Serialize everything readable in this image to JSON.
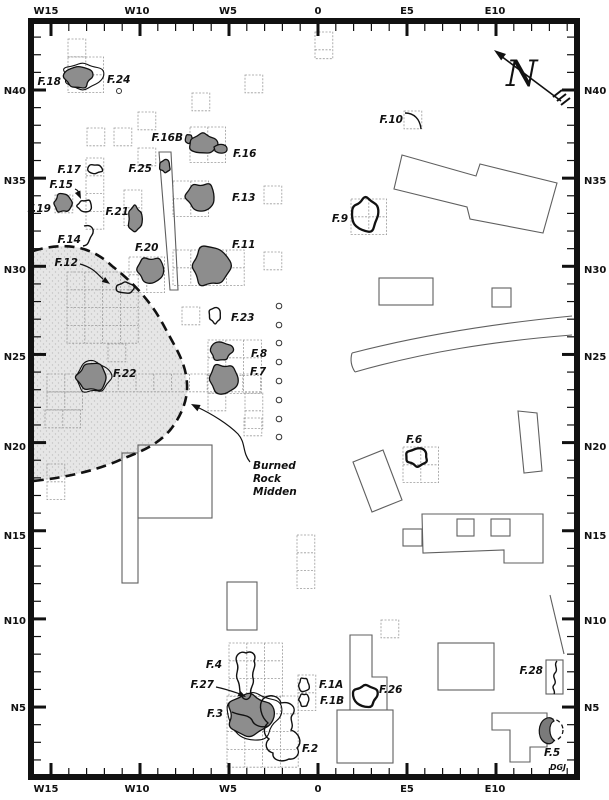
{
  "credit": "DGJ",
  "north": {
    "letter": "N",
    "shaft": [
      561,
      101,
      497,
      53
    ],
    "tip": [
      494,
      50
    ],
    "tip_angle": 217,
    "letter_pos": [
      506,
      86
    ]
  },
  "colors": {
    "feature_fill": "#8d8d8d",
    "feature_stroke": "#111111",
    "midden_fill": "#e6e6e6",
    "midden_dot": "#c2c2c2",
    "grid_stroke": "#9a9a9a",
    "structure_stroke": "#5f5f5f",
    "frame": "#111111"
  },
  "axis": {
    "top_labels": [
      {
        "t": "W15",
        "x": 46
      },
      {
        "t": "W10",
        "x": 137
      },
      {
        "t": "W5",
        "x": 228
      },
      {
        "t": "0",
        "x": 318
      },
      {
        "t": "E5",
        "x": 407
      },
      {
        "t": "E10",
        "x": 495
      }
    ],
    "bottom_labels": [
      {
        "t": "W15",
        "x": 46
      },
      {
        "t": "W10",
        "x": 137
      },
      {
        "t": "W5",
        "x": 228
      },
      {
        "t": "0",
        "x": 318
      },
      {
        "t": "E5",
        "x": 407
      },
      {
        "t": "E10",
        "x": 495
      }
    ],
    "left_labels": [
      {
        "t": "N40",
        "y": 90
      },
      {
        "t": "N35",
        "y": 180
      },
      {
        "t": "N30",
        "y": 269
      },
      {
        "t": "N25",
        "y": 356
      },
      {
        "t": "N20",
        "y": 446
      },
      {
        "t": "N15",
        "y": 535
      },
      {
        "t": "N10",
        "y": 620
      },
      {
        "t": "N5",
        "y": 707
      }
    ],
    "right_labels": [
      {
        "t": "N40",
        "y": 90
      },
      {
        "t": "N35",
        "y": 180
      },
      {
        "t": "N30",
        "y": 269
      },
      {
        "t": "N25",
        "y": 356
      },
      {
        "t": "N20",
        "y": 446
      },
      {
        "t": "N15",
        "y": 535
      },
      {
        "t": "N10",
        "y": 620
      },
      {
        "t": "N5",
        "y": 707
      }
    ],
    "origin_x": 318,
    "px_per_m_x": 17.8,
    "origin_y": 90,
    "px_per_m_y": 17.63,
    "minor_len": 7,
    "major_len": 12,
    "frame": {
      "x": 31,
      "y": 21,
      "w": 546,
      "h": 756,
      "stroke_w": 6
    },
    "inner": {
      "top": 24,
      "bottom": 775,
      "left": 34,
      "right": 574
    }
  },
  "midden": {
    "label_lines": [
      "Burned",
      "Rock",
      "Midden"
    ],
    "label_x": 253,
    "label_y0": 469,
    "line_h": 13,
    "fill_path": "M33,251 C60,243 88,243 112,266 C134,283 152,303 164,326 C175,347 186,362 187,384 C188,400 181,416 171,429 C158,445 140,452 122,459 C103,468 72,477 33,481 Z",
    "dash_path": "M33,251 C60,243 88,243 112,266 C134,283 152,303 164,326 C175,347 186,362 187,384 C188,400 181,416 171,429 C158,445 140,452 122,459 C103,468 72,477 33,481",
    "leader_path": "M250,462 C242,452 246,443 238,434 C228,424 212,414 197,407",
    "leader_tip": [
      191,
      404
    ],
    "leader_angle": 207
  },
  "grid": {
    "unit": 17.8,
    "clusters": [
      [
        68,
        39,
        1,
        1
      ],
      [
        68,
        57,
        2,
        2
      ],
      [
        87,
        128,
        1,
        1
      ],
      [
        114,
        128,
        1,
        1
      ],
      [
        138,
        112,
        1,
        1
      ],
      [
        190,
        127,
        2,
        2
      ],
      [
        192,
        93,
        1,
        1
      ],
      [
        245,
        75,
        1,
        1
      ],
      [
        315,
        32,
        1,
        1.5
      ],
      [
        86,
        158,
        1,
        4
      ],
      [
        55,
        195,
        1,
        1
      ],
      [
        138,
        148,
        1,
        1
      ],
      [
        124,
        190,
        1,
        2
      ],
      [
        173,
        181,
        2,
        2
      ],
      [
        264,
        186,
        1,
        1
      ],
      [
        264,
        252,
        1,
        1
      ],
      [
        129,
        257,
        2,
        2
      ],
      [
        173,
        250,
        4,
        2
      ],
      [
        182,
        307,
        1,
        1
      ],
      [
        67,
        272,
        4,
        4
      ],
      [
        108,
        344,
        1,
        1
      ],
      [
        47,
        374,
        12,
        1
      ],
      [
        47,
        392,
        2,
        1
      ],
      [
        45,
        410,
        2,
        1
      ],
      [
        47,
        464,
        1,
        2
      ],
      [
        208,
        340,
        3,
        3
      ],
      [
        208,
        393,
        1,
        1
      ],
      [
        245,
        393,
        1,
        2
      ],
      [
        297,
        535,
        1,
        3
      ],
      [
        244,
        418,
        1,
        1
      ],
      [
        229,
        643,
        3,
        3
      ],
      [
        227,
        696,
        4,
        4
      ],
      [
        298,
        675,
        1,
        2
      ],
      [
        381,
        620,
        1,
        1
      ],
      [
        351,
        199,
        2,
        2
      ],
      [
        403,
        447,
        2,
        2
      ],
      [
        404,
        111,
        1,
        1
      ]
    ]
  },
  "structures": {
    "rects": [
      [
        379,
        278,
        54,
        27
      ],
      [
        492,
        288,
        19,
        19
      ],
      [
        438,
        643,
        56,
        47
      ],
      [
        337,
        710,
        56,
        53
      ],
      [
        122,
        453,
        16,
        130
      ],
      [
        138,
        445,
        74,
        73
      ],
      [
        227,
        582,
        30,
        48
      ],
      [
        403,
        529,
        19,
        17
      ],
      [
        457,
        519,
        17,
        17
      ],
      [
        491,
        519,
        19,
        17
      ],
      [
        546,
        660,
        17,
        34
      ]
    ],
    "polys": [
      [
        [
          402,
          155
        ],
        [
          476,
          176
        ],
        [
          480,
          164
        ],
        [
          557,
          183
        ],
        [
          543,
          233
        ],
        [
          470,
          219
        ],
        [
          467,
          207
        ],
        [
          394,
          189
        ]
      ],
      [
        [
          353,
          462
        ],
        [
          383,
          450
        ],
        [
          402,
          500
        ],
        [
          372,
          512
        ]
      ],
      [
        [
          518,
          411
        ],
        [
          537,
          413
        ],
        [
          542,
          471
        ],
        [
          524,
          473
        ]
      ],
      [
        [
          422,
          514
        ],
        [
          543,
          514
        ],
        [
          543,
          563
        ],
        [
          504,
          563
        ],
        [
          504,
          550
        ],
        [
          423,
          553
        ]
      ],
      [
        [
          159,
          152
        ],
        [
          171,
          152
        ],
        [
          178,
          290
        ],
        [
          170,
          290
        ]
      ]
    ],
    "paths": [
      "M352,353 C410,338 480,325 572,316",
      "M355,372 C425,352 495,341 572,335",
      "M352,353 C350,360 351,366 355,372",
      "M350,635 L372,635 L372,677 L387,677 L387,710 L350,710 Z",
      "M492,713 L547,713 L547,747 L530,747 L530,762 L510,762 L510,730 L492,730 Z"
    ],
    "lines": [
      [
        550,
        595,
        564,
        654
      ]
    ]
  },
  "circles": {
    "column_x": 279,
    "ys": [
      306,
      325,
      343,
      362,
      381,
      400,
      419,
      437
    ],
    "r": 2.8,
    "single": [
      119,
      91,
      2.5
    ]
  },
  "features": [
    {
      "id": "F.18",
      "label": {
        "x": 61,
        "y": 85,
        "anchor": "end"
      },
      "shapes": [
        {
          "kind": "wobble",
          "cx": 83,
          "cy": 76,
          "rx": 20,
          "ry": 13,
          "seed": 7,
          "style": "halo"
        },
        {
          "kind": "wobble",
          "cx": 78,
          "cy": 77,
          "rx": 14,
          "ry": 11,
          "seed": 3,
          "style": "dark"
        }
      ]
    },
    {
      "id": "F.24",
      "label": {
        "x": 107,
        "y": 83,
        "anchor": "start"
      },
      "shapes": []
    },
    {
      "id": "F.16B",
      "label": {
        "x": 183,
        "y": 141,
        "anchor": "end"
      },
      "shapes": [
        {
          "kind": "wobble",
          "cx": 189,
          "cy": 139,
          "rx": 4,
          "ry": 4.5,
          "seed": 11,
          "style": "dark"
        }
      ]
    },
    {
      "id": "F.16",
      "label": {
        "x": 233,
        "y": 157,
        "anchor": "start"
      },
      "shapes": [
        {
          "kind": "wobble",
          "cx": 203,
          "cy": 144,
          "rx": 14,
          "ry": 10,
          "seed": 5,
          "style": "dark"
        },
        {
          "kind": "path",
          "d": "M214,147 C221,142 228,145 227,150 C226,154 219,154 215,151 Z",
          "style": "dark"
        }
      ]
    },
    {
      "id": "F.25",
      "label": {
        "x": 152,
        "y": 172,
        "anchor": "end"
      },
      "shapes": [
        {
          "kind": "wobble",
          "cx": 165,
          "cy": 166,
          "rx": 5.5,
          "ry": 6.5,
          "seed": 9,
          "style": "dark"
        }
      ]
    },
    {
      "id": "F.17",
      "label": {
        "x": 81,
        "y": 173,
        "anchor": "end"
      },
      "shapes": [
        {
          "kind": "wobble",
          "cx": 95,
          "cy": 169,
          "rx": 8,
          "ry": 4.5,
          "seed": 4,
          "style": "outline"
        }
      ]
    },
    {
      "id": "F.15",
      "label": {
        "x": 73,
        "y": 188,
        "anchor": "end"
      },
      "shapes": [
        {
          "kind": "wobble",
          "cx": 85,
          "cy": 206,
          "rx": 7.5,
          "ry": 6,
          "seed": 6,
          "style": "outline"
        },
        {
          "kind": "arrow",
          "d": "M75,189 C80,191 79,195 80,197",
          "tip": [
            81,
            199
          ],
          "ang": 65
        }
      ]
    },
    {
      "id": "F.19",
      "label": {
        "x": 51,
        "y": 212,
        "anchor": "end"
      },
      "shapes": [
        {
          "kind": "wobble",
          "cx": 63,
          "cy": 203,
          "rx": 9,
          "ry": 9.5,
          "seed": 8,
          "style": "dark"
        }
      ]
    },
    {
      "id": "F.13",
      "label": {
        "x": 232,
        "y": 201,
        "anchor": "start"
      },
      "shapes": [
        {
          "kind": "wobble",
          "cx": 201,
          "cy": 197,
          "rx": 15,
          "ry": 14,
          "seed": 13,
          "style": "dark"
        }
      ]
    },
    {
      "id": "F.21",
      "label": {
        "x": 129,
        "y": 215,
        "anchor": "end"
      },
      "shapes": [
        {
          "kind": "wobble",
          "cx": 135,
          "cy": 219,
          "rx": 7,
          "ry": 13,
          "seed": 21,
          "style": "dark"
        }
      ]
    },
    {
      "id": "F.14",
      "label": {
        "x": 81,
        "y": 243,
        "anchor": "end"
      },
      "shapes": [
        {
          "kind": "open",
          "d": "M84,226 C92,224 95,230 92,235 C88,240 90,245 83,246"
        }
      ]
    },
    {
      "id": "F.20",
      "label": {
        "x": 135,
        "y": 251,
        "anchor": "start"
      },
      "shapes": [
        {
          "kind": "wobble",
          "cx": 151,
          "cy": 270,
          "rx": 14,
          "ry": 13,
          "seed": 20,
          "style": "dark"
        }
      ]
    },
    {
      "id": "F.11",
      "label": {
        "x": 232,
        "y": 248,
        "anchor": "start"
      },
      "shapes": [
        {
          "kind": "wobble",
          "cx": 211,
          "cy": 266,
          "rx": 19,
          "ry": 20,
          "seed": 1,
          "style": "dark"
        }
      ]
    },
    {
      "id": "F.12",
      "label": {
        "x": 78,
        "y": 266,
        "anchor": "end"
      },
      "shapes": [
        {
          "kind": "wobble",
          "cx": 125,
          "cy": 288,
          "rx": 9,
          "ry": 5.5,
          "seed": 12,
          "style": "outline"
        },
        {
          "kind": "arrow",
          "d": "M80,264 C94,268 97,274 103,279",
          "tip": [
            110,
            284
          ],
          "ang": 35
        }
      ]
    },
    {
      "id": "F.23",
      "label": {
        "x": 231,
        "y": 321,
        "anchor": "start"
      },
      "shapes": [
        {
          "kind": "wobble",
          "cx": 215,
          "cy": 315,
          "rx": 6,
          "ry": 8,
          "seed": 23,
          "style": "outline"
        }
      ]
    },
    {
      "id": "F.8",
      "label": {
        "x": 251,
        "y": 357,
        "anchor": "start"
      },
      "shapes": [
        {
          "kind": "wobble",
          "cx": 221,
          "cy": 351,
          "rx": 11,
          "ry": 9.5,
          "seed": 17,
          "style": "dark"
        }
      ]
    },
    {
      "id": "F.7",
      "label": {
        "x": 250,
        "y": 375,
        "anchor": "start"
      },
      "shapes": [
        {
          "kind": "wobble",
          "cx": 224,
          "cy": 379,
          "rx": 15,
          "ry": 15,
          "seed": 27,
          "style": "dark"
        }
      ]
    },
    {
      "id": "F.22",
      "label": {
        "x": 113,
        "y": 377,
        "anchor": "start"
      },
      "shapes": [
        {
          "kind": "wobble",
          "cx": 93,
          "cy": 377,
          "rx": 17,
          "ry": 16,
          "seed": 31,
          "style": "halo"
        },
        {
          "kind": "wobble",
          "cx": 92,
          "cy": 377,
          "rx": 15,
          "ry": 14,
          "seed": 22,
          "style": "dark"
        }
      ]
    },
    {
      "id": "F.10",
      "label": {
        "x": 403,
        "y": 123,
        "anchor": "end"
      },
      "shapes": [
        {
          "kind": "open",
          "d": "M405,113 C414,113 420,119 421,129"
        }
      ]
    },
    {
      "id": "F.9",
      "label": {
        "x": 348,
        "y": 222,
        "anchor": "end"
      },
      "shapes": [
        {
          "kind": "wobble",
          "cx": 365,
          "cy": 215,
          "rx": 13,
          "ry": 17,
          "seed": 19,
          "style": "thick"
        }
      ]
    },
    {
      "id": "F.6",
      "label": {
        "x": 406,
        "y": 443,
        "anchor": "start"
      },
      "shapes": [
        {
          "kind": "wobble",
          "cx": 417,
          "cy": 457,
          "rx": 11,
          "ry": 9,
          "seed": 16,
          "style": "thick"
        }
      ]
    },
    {
      "id": "F.3",
      "label": {
        "x": 223,
        "y": 717,
        "anchor": "end"
      },
      "shapes": [
        {
          "kind": "wobble",
          "cx": 253,
          "cy": 716,
          "rx": 26,
          "ry": 24,
          "seed": 33,
          "style": "halo"
        },
        {
          "kind": "wobble",
          "cx": 250,
          "cy": 715,
          "rx": 23,
          "ry": 21,
          "seed": 14,
          "style": "dark"
        },
        {
          "kind": "open",
          "d": "M232,712 C240,716 248,714 252,720 C254,726 262,728 268,726"
        }
      ]
    },
    {
      "id": "F.4",
      "label": {
        "x": 222,
        "y": 668,
        "anchor": "end"
      },
      "shapes": [
        {
          "kind": "path",
          "d": "M243,698 C238,693 241,687 238,681 C234,674 240,670 237,663 C234,656 240,650 246,653 C252,650 257,655 254,661 C257,667 251,671 253,678 C255,685 249,688 251,694 C250,699 246,701 243,698 Z",
          "style": "outline"
        }
      ]
    },
    {
      "id": "F.27",
      "label": {
        "x": 214,
        "y": 688,
        "anchor": "end"
      },
      "shapes": [
        {
          "kind": "arrow",
          "d": "M216,687 C226,689 234,692 240,694",
          "tip": [
            246,
            697
          ],
          "ang": 27
        }
      ]
    },
    {
      "id": "F.2",
      "label": {
        "x": 302,
        "y": 752,
        "anchor": "start"
      },
      "shapes": [
        {
          "kind": "path",
          "d": "M263,699 C270,693 279,696 281,703 C290,701 297,707 293,714 C288,719 295,724 291,730 C299,733 303,742 297,748 C301,753 296,760 289,759 C281,763 272,760 273,753 C266,751 264,744 269,739 C263,735 263,727 268,723 C261,717 258,705 263,699 Z",
          "style": "outline"
        }
      ]
    },
    {
      "id": "F.1A",
      "label": {
        "x": 319,
        "y": 688,
        "anchor": "start"
      },
      "shapes": [
        {
          "kind": "wobble",
          "cx": 304,
          "cy": 685,
          "rx": 5.5,
          "ry": 7,
          "seed": 41,
          "style": "outline"
        }
      ]
    },
    {
      "id": "F.1B",
      "label": {
        "x": 320,
        "y": 704,
        "anchor": "start"
      },
      "shapes": [
        {
          "kind": "wobble",
          "cx": 304,
          "cy": 700,
          "rx": 5,
          "ry": 6.5,
          "seed": 43,
          "style": "outline"
        }
      ]
    },
    {
      "id": "F.26",
      "label": {
        "x": 379,
        "y": 693,
        "anchor": "start"
      },
      "shapes": [
        {
          "kind": "wobble",
          "cx": 365,
          "cy": 696,
          "rx": 12,
          "ry": 11,
          "seed": 26,
          "style": "thick"
        }
      ]
    },
    {
      "id": "F.28",
      "label": {
        "x": 543,
        "y": 674,
        "anchor": "end"
      },
      "shapes": [
        {
          "kind": "open",
          "d": "M557,661 C553,665 559,669 555,673 C551,677 558,681 554,685 C551,688 556,691 554,694"
        }
      ]
    },
    {
      "id": "F.5",
      "label": {
        "x": 544,
        "y": 756,
        "anchor": "start"
      },
      "shapes": [
        {
          "kind": "dashcircle",
          "cx": 552,
          "cy": 730,
          "r": 11
        },
        {
          "kind": "path",
          "d": "M545,719 C538,723 537,737 544,742 C548,745 553,744 554,740 C549,737 548,724 554,721 C552,717 548,717 545,719 Z",
          "style": "crescent"
        }
      ]
    }
  ]
}
